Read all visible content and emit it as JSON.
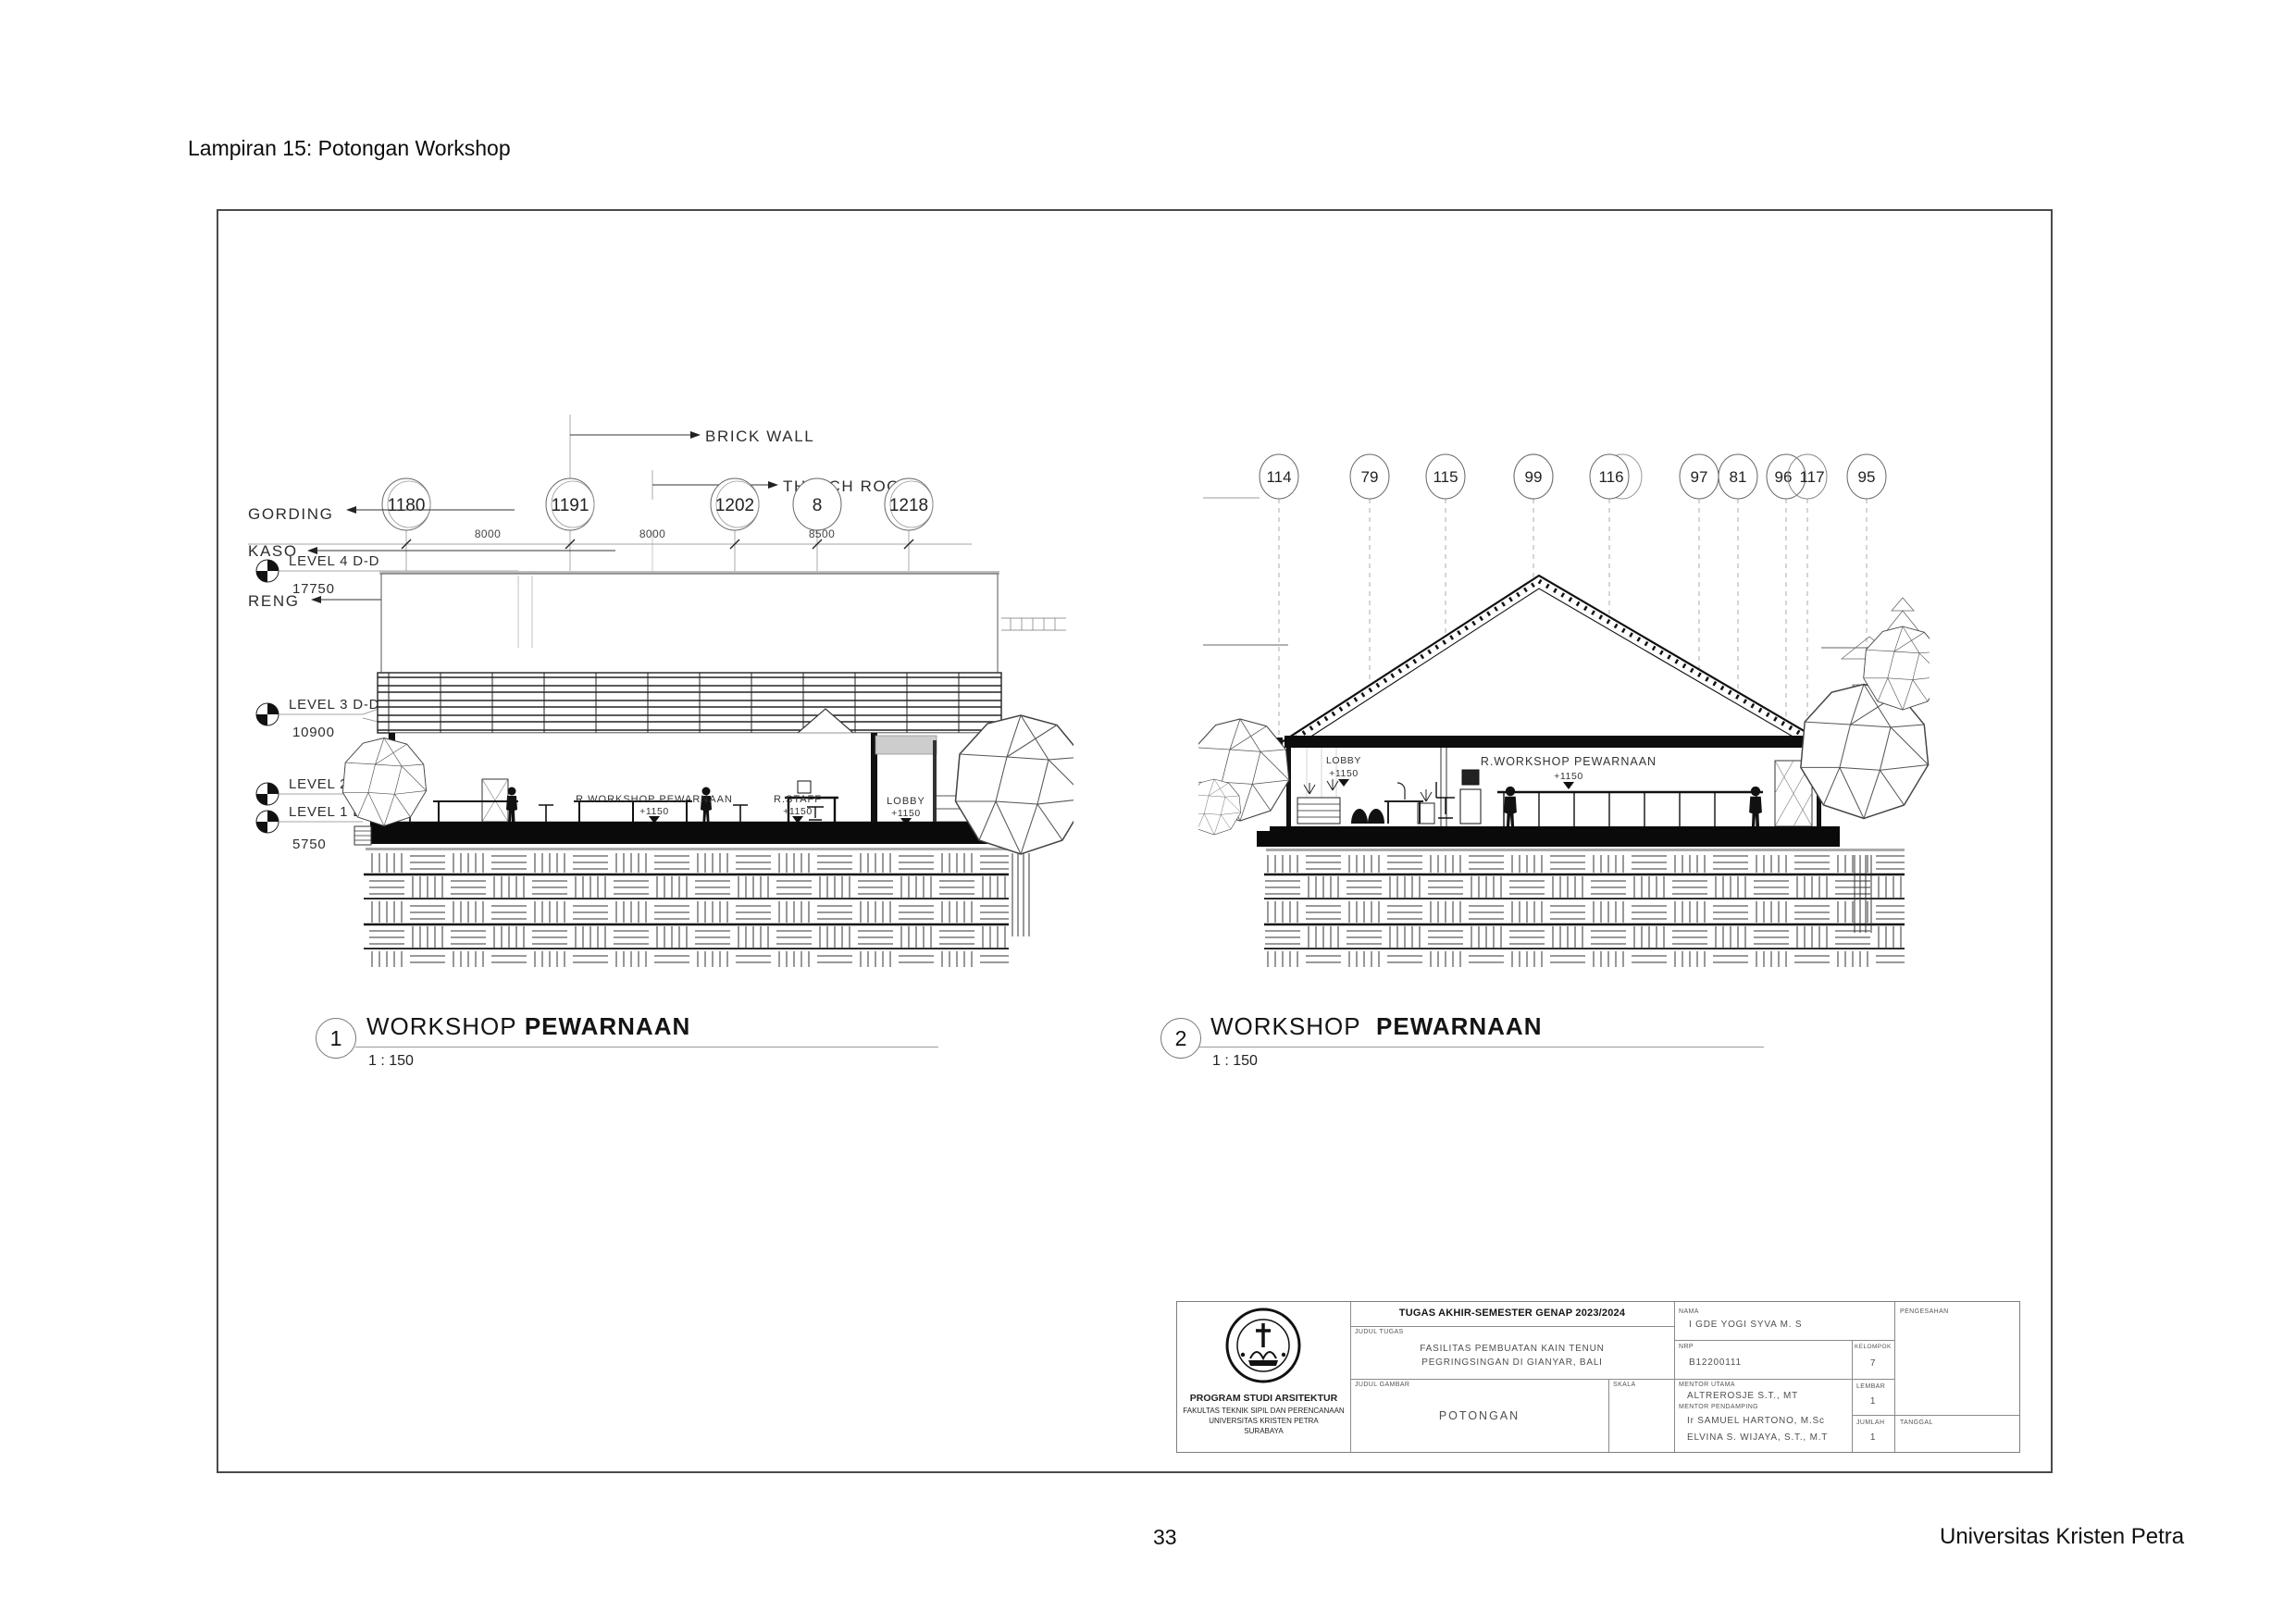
{
  "page": {
    "heading": "Lampiran 15: Potongan Workshop",
    "page_number": "33",
    "footer_right": "Universitas Kristen Petra"
  },
  "d1": {
    "number": "1",
    "title_main": "WORKSHOP",
    "title_bold": "PEWARNAAN",
    "scale": "1 : 150",
    "bubbles": [
      "1180",
      "1191",
      "1202",
      "8",
      "1218"
    ],
    "dims": [
      "8000",
      "8000",
      "8500"
    ],
    "callout_brick": "BRICK WALL",
    "callout_thatch": "THATCH ROOF",
    "label_gording": "GORDING",
    "label_kaso": "KASO",
    "label_reng": "RENG",
    "levels": [
      {
        "label": "LEVEL 4 D-D",
        "value": "17750"
      },
      {
        "label": "LEVEL 3 D-D",
        "value": "10900"
      },
      {
        "label": "LEVEL 2 D-D",
        "value": ""
      },
      {
        "label": "LEVEL 1 D-D",
        "value": "5750"
      }
    ],
    "rooms": [
      {
        "name": "R.WORKSHOP PEWARNAAN",
        "elev": "+1150"
      },
      {
        "name": "R.STAFF",
        "elev": "+1150"
      },
      {
        "name": "LOBBY",
        "elev": "+1150"
      }
    ]
  },
  "d2": {
    "number": "2",
    "title_main": "WORKSHOP",
    "title_bold": "PEWARNAAN",
    "scale": "1 : 150",
    "bubbles": [
      "114",
      "79",
      "115",
      "99",
      "116",
      "97",
      "81",
      "96",
      "117",
      "95"
    ],
    "rooms": [
      {
        "name": "LOBBY",
        "elev": "+1150"
      },
      {
        "name": "R.WORKSHOP PEWARNAAN",
        "elev": "+1150"
      }
    ]
  },
  "title_block": {
    "header": "TUGAS AKHIR-SEMESTER GENAP 2023/2024",
    "judul_tugas_label": "JUDUL TUGAS",
    "judul_tugas_line1": "FASILITAS PEMBUATAN KAIN TENUN",
    "judul_tugas_line2": "PEGRINGSINGAN DI GIANYAR, BALI",
    "judul_gambar_label": "JUDUL GAMBAR",
    "judul_gambar": "POTONGAN",
    "skala_label": "SKALA",
    "nama_label": "NAMA",
    "nama": "I GDE YOGI SYVA M. S",
    "nrp_label": "NRP",
    "nrp": "B12200111",
    "kelompok_label": "KELOMPOK",
    "kelompok": "7",
    "pengesahan_label": "PENGESAHAN",
    "mentor_utama_label": "MENTOR UTAMA",
    "mentor_utama": "ALTREROSJE S.T., MT",
    "mentor_pendamping_label": "MENTOR PENDAMPING",
    "mentor_pendamping_1": "Ir SAMUEL HARTONO, M.Sc",
    "mentor_pendamping_2": "ELVINA S. WIJAYA, S.T., M.T",
    "lembar_label": "LEMBAR",
    "lembar": "1",
    "jumlah_label": "JUMLAH",
    "jumlah": "1",
    "tanggal_label": "TANGGAL",
    "institution": {
      "program": "PROGRAM STUDI ARSITEKTUR",
      "fakultas": "FAKULTAS TEKNIK SIPIL DAN PERENCANAAN",
      "universitas": "UNIVERSITAS KRISTEN PETRA",
      "kota": "SURABAYA"
    }
  }
}
